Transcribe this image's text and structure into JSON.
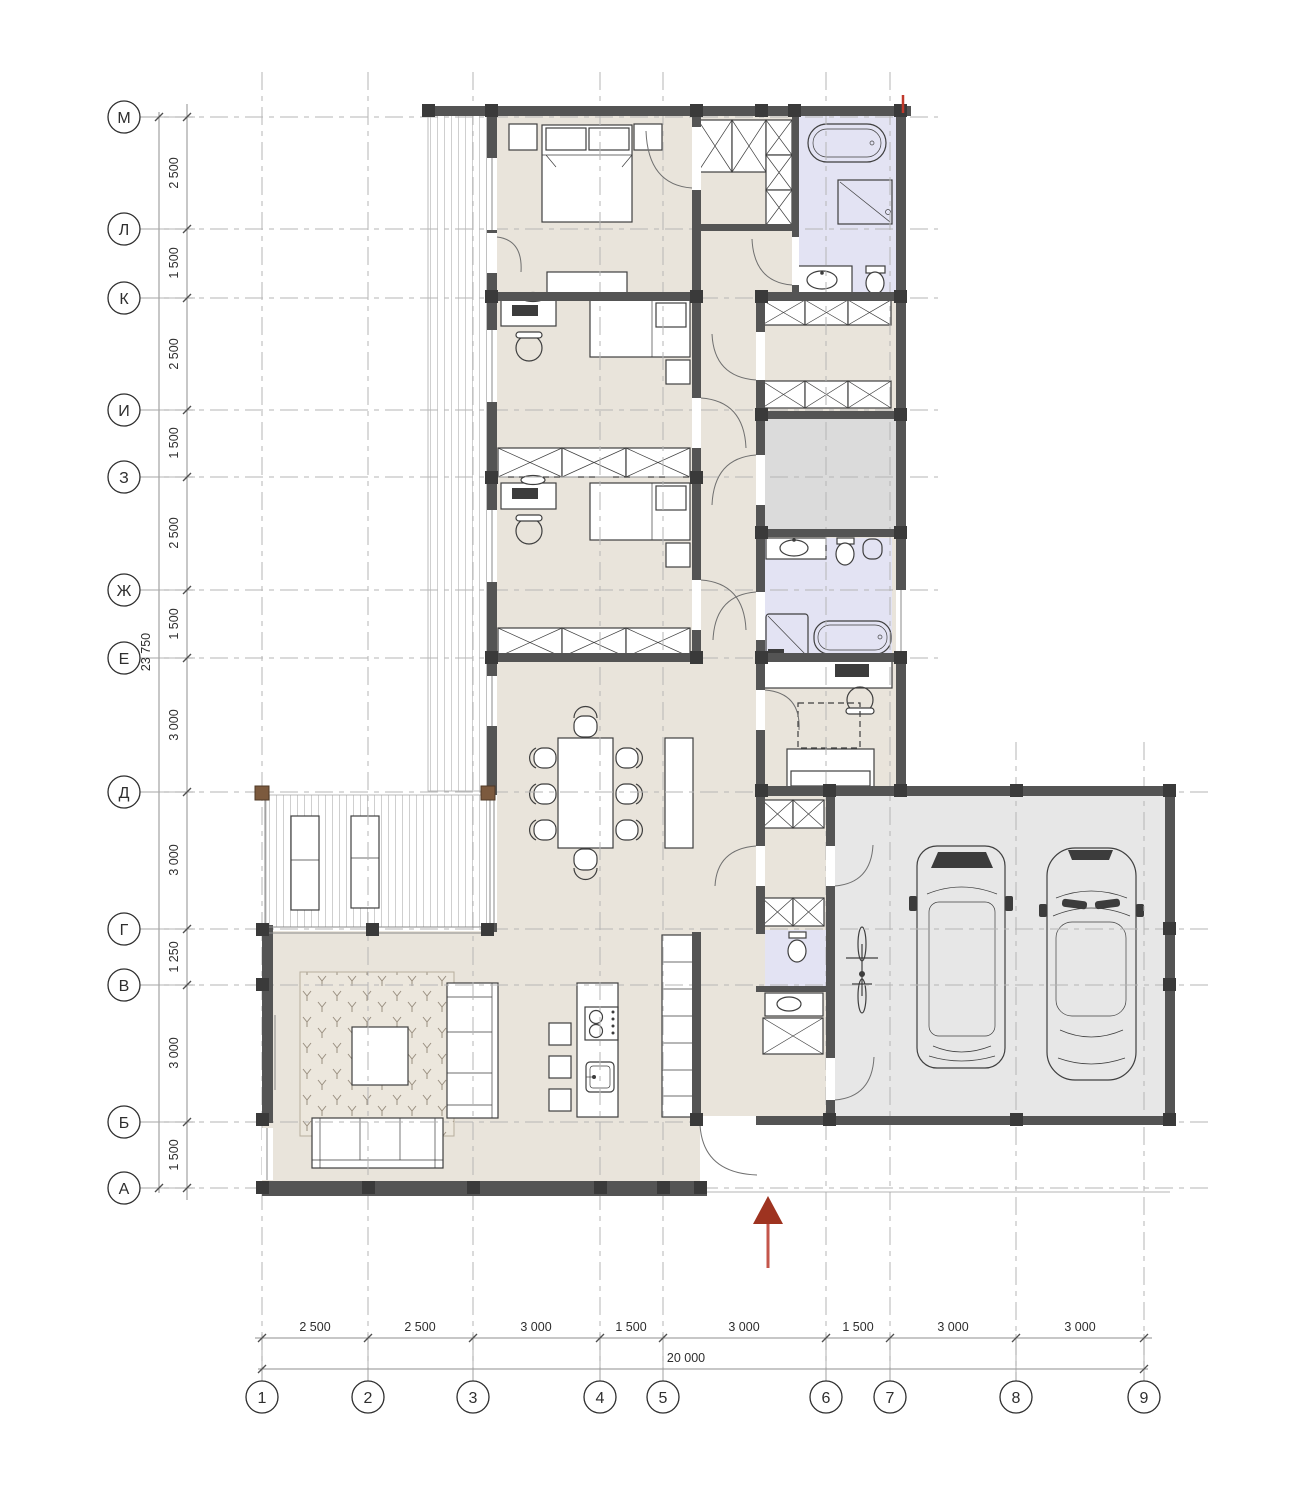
{
  "axes": {
    "rows": [
      "М",
      "Л",
      "К",
      "И",
      "З",
      "Ж",
      "Е",
      "Д",
      "Г",
      "В",
      "Б",
      "А"
    ],
    "row_spacings": [
      "2 500",
      "1 500",
      "2 500",
      "1 500",
      "2 500",
      "1 500",
      "3 000",
      "3 000",
      "1 250",
      "3 000",
      "1 500"
    ],
    "row_total": "23 750",
    "cols": [
      "1",
      "2",
      "3",
      "4",
      "5",
      "6",
      "7",
      "8",
      "9"
    ],
    "col_spacings": [
      "2 500",
      "2 500",
      "3 000",
      "1 500",
      "3 000",
      "1 500",
      "3 000",
      "3 000"
    ],
    "col_total": "20 000"
  },
  "colors": {
    "wall": "#545454",
    "floor": "#e9e4db",
    "bath": "#e3e3f3",
    "storage": "#dbdbdb",
    "garage": "#e7e7e7",
    "wood": "#7c5a3e",
    "grid": "#b6b6b6",
    "dim": "#8f8f8f",
    "line": "#3f3f3f",
    "red": "#9e3320",
    "redl": "#c4564b"
  }
}
